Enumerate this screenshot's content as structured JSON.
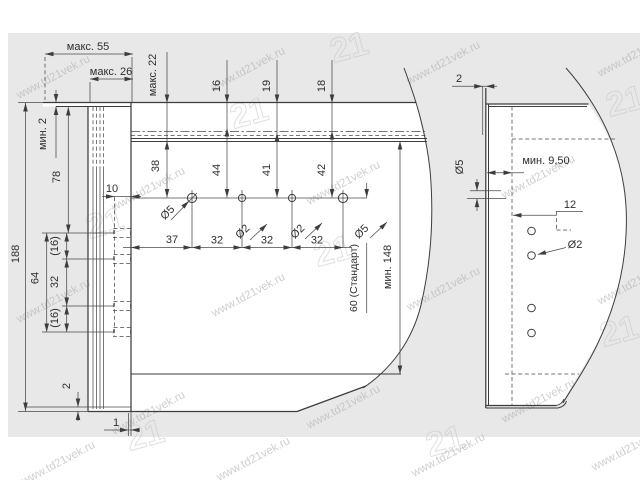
{
  "watermark": {
    "url": "www.td21vek.ru",
    "logo": "21"
  },
  "lv": {
    "maks55": "макс. 55",
    "maks26": "макс. 26",
    "maks22": "макс. 22",
    "min2": "мин. 2",
    "h78": "78",
    "h188": "188",
    "h10": "10",
    "h64": "64",
    "g16a": "(16)",
    "h32": "32",
    "g16b": "(16)",
    "b2": "2",
    "b1": "1",
    "t16": "16",
    "t19": "19",
    "t18": "18",
    "v38": "38",
    "v44": "44",
    "v41": "41",
    "v42": "42",
    "c37": "37",
    "c32a": "32",
    "c32b": "32",
    "c32c": "32",
    "dia5a": "Ø5",
    "dia2a": "Ø2",
    "dia2b": "Ø2",
    "dia5b": "Ø5",
    "min148": "мин. 148",
    "std60": "60 (Стандарт)"
  },
  "rv": {
    "r2": "2",
    "min950": "мин. 9,50",
    "dia5": "Ø5",
    "r12": "12",
    "dia2": "Ø2"
  }
}
